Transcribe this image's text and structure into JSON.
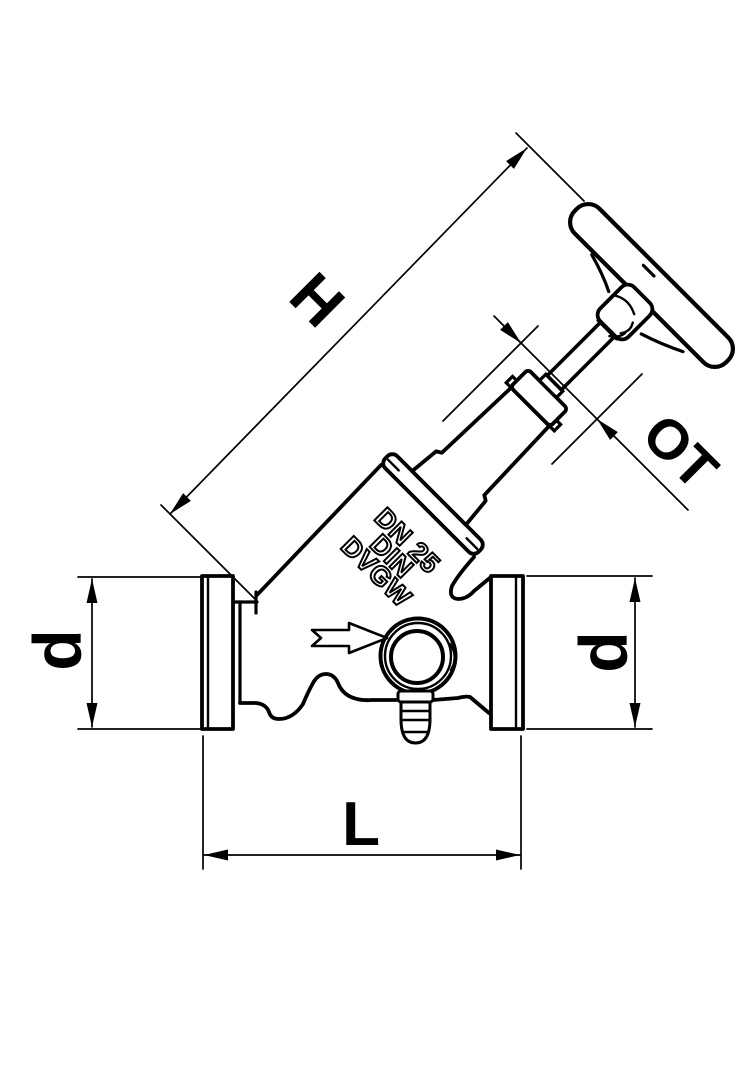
{
  "drawing": {
    "background": "#ffffff",
    "line_color": "#000000",
    "dimension_labels": {
      "h": "H",
      "ot": "OT",
      "d_left": "d",
      "d_right": "d",
      "l": "L"
    },
    "cast_markings": {
      "line1": "DN 25",
      "line2": "DIN",
      "line3": "DVGW"
    }
  }
}
